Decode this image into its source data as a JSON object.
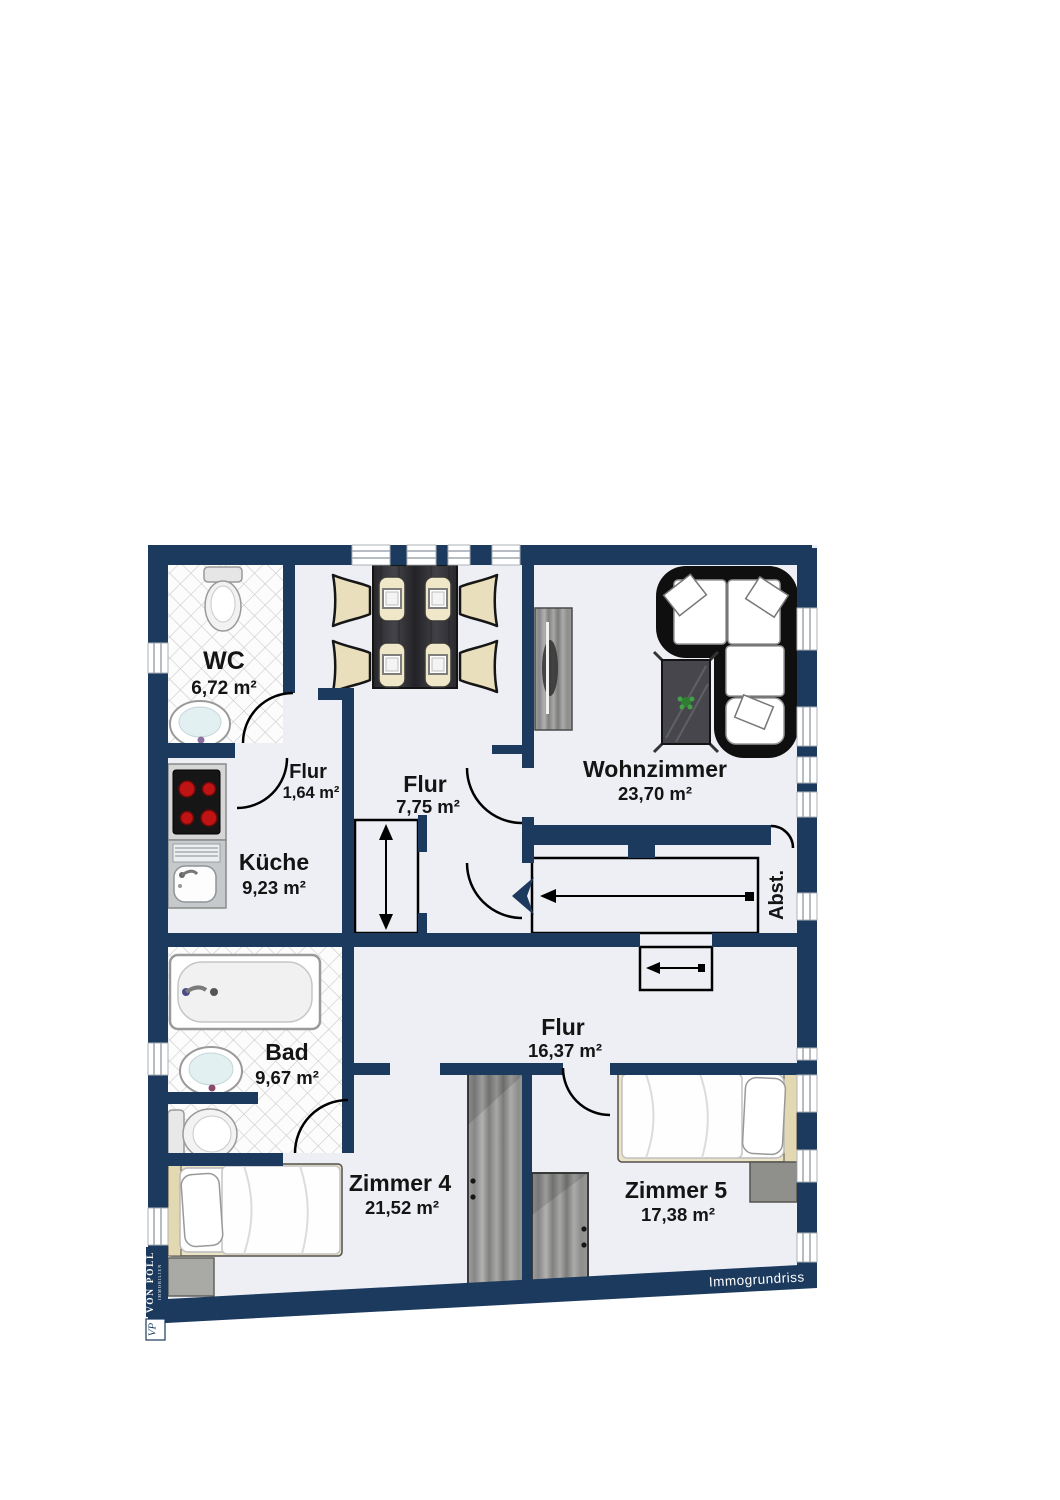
{
  "colors": {
    "wall_navy": "#1b3a5e",
    "floor": "#edeff5",
    "tile_line": "#cccccc",
    "burner_red": "#c01414",
    "label_text": "#141414"
  },
  "rooms": {
    "wc": {
      "name": "WC",
      "area": "6,72 m²"
    },
    "flur_klein": {
      "name": "Flur",
      "area": "1,64 m²"
    },
    "flur_mitte": {
      "name": "Flur",
      "area": "7,75 m²"
    },
    "wohnzimmer": {
      "name": "Wohnzimmer",
      "area": "23,70 m²"
    },
    "kueche": {
      "name": "Küche",
      "area": "9,23 m²"
    },
    "abstellraum": {
      "name": "Abst."
    },
    "bad": {
      "name": "Bad",
      "area": "9,67 m²"
    },
    "flur_gross": {
      "name": "Flur",
      "area": "16,37 m²"
    },
    "zimmer4": {
      "name": "Zimmer 4",
      "area": "21,52 m²"
    },
    "zimmer5": {
      "name": "Zimmer 5",
      "area": "17,38 m²"
    }
  },
  "branding": {
    "watermark": "Immogrundriss",
    "logo_name": "VON POLL",
    "logo_sub": "IMMOBILIEN",
    "logo_monogram": "VP"
  }
}
